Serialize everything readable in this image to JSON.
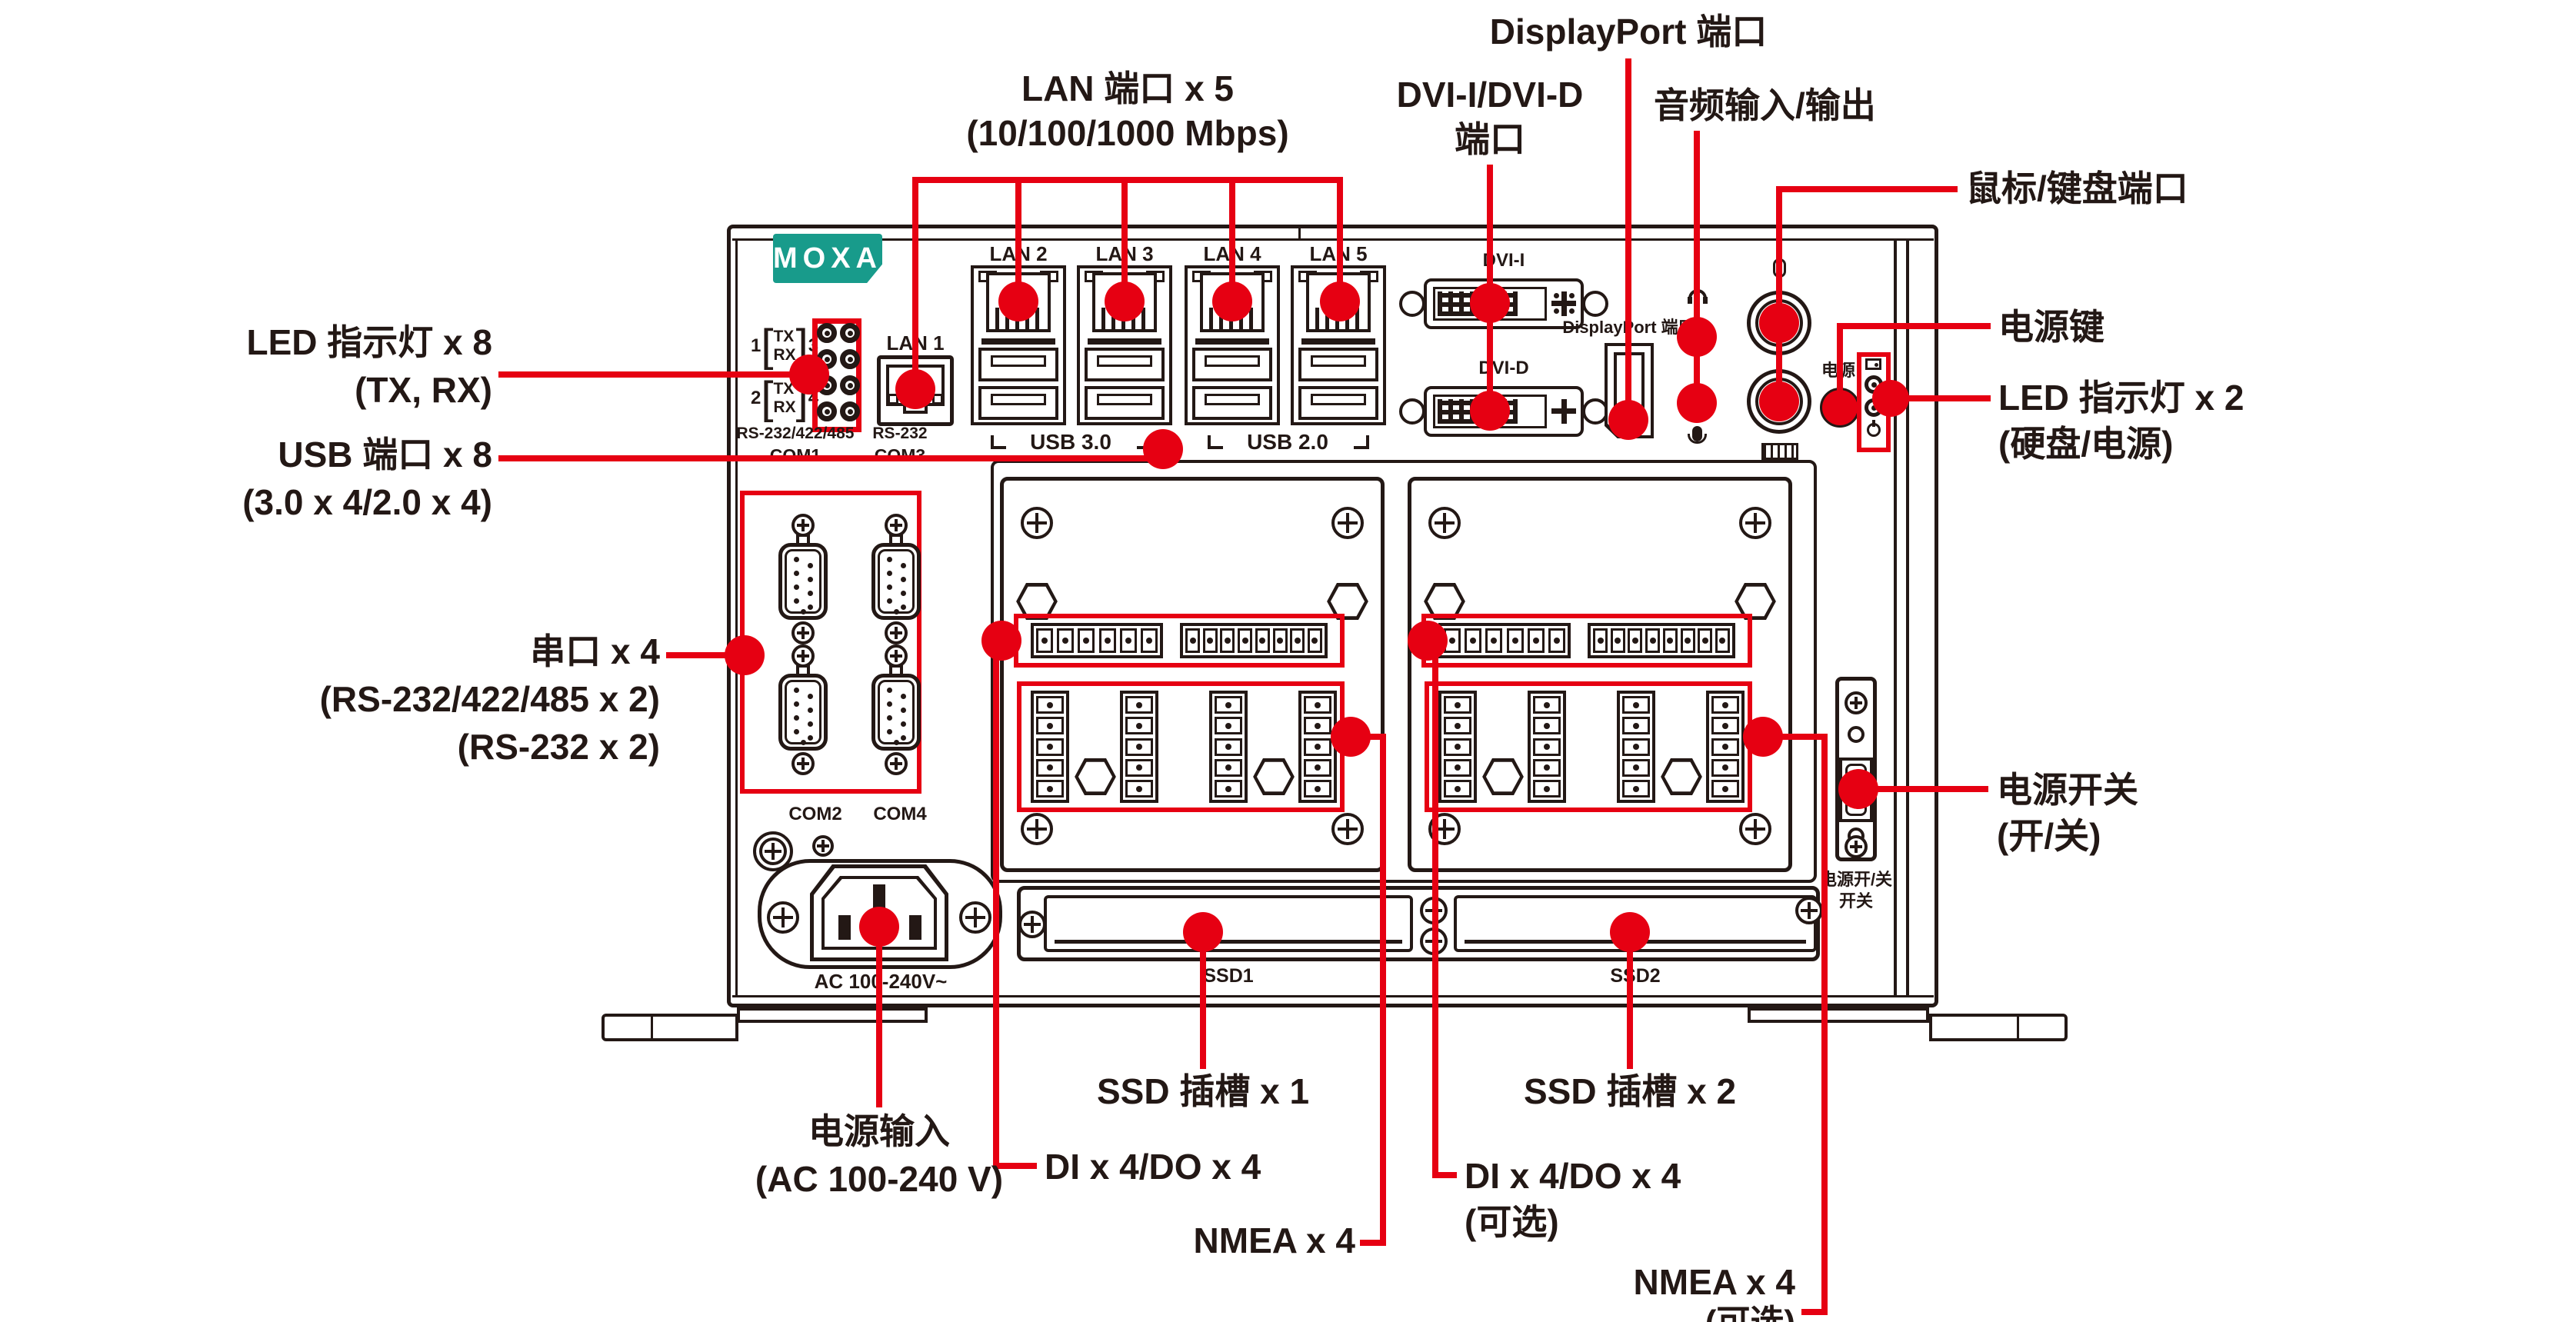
{
  "figure": {
    "brand": "MOXA",
    "colors": {
      "accent": "#E60012",
      "brand_teal": "#189B8B",
      "line_art": "#231815"
    },
    "callouts": {
      "lan": {
        "line1": "LAN 端口 x 5",
        "line2": "(10/100/1000 Mbps)"
      },
      "dvi": {
        "line1": "DVI-I/DVI-D",
        "line2": "端口"
      },
      "displayport": {
        "line1": "DisplayPort 端口"
      },
      "audio": {
        "line1": "音频输入/输出"
      },
      "mouse_keyboard": {
        "line1": "鼠标/键盘端口"
      },
      "led8": {
        "line1": "LED 指示灯 x 8",
        "line2": "(TX, RX)"
      },
      "usb8": {
        "line1": "USB 端口 x 8",
        "line2": "(3.0 x 4/2.0 x 4)"
      },
      "serial": {
        "line1": "串口 x 4",
        "line2": "(RS-232/422/485 x 2)",
        "line3": "(RS-232 x 2)"
      },
      "power_button": {
        "line1": "电源键"
      },
      "led2": {
        "line1": "LED 指示灯 x 2",
        "line2": "(硬盘/电源)"
      },
      "power_switch": {
        "line1": "电源开关",
        "line2": "(开/关)"
      },
      "power_input": {
        "line1": "电源输入",
        "line2": "(AC 100-240 V)"
      },
      "dido_left": {
        "line1": "DI x 4/DO x 4"
      },
      "nmea_left": {
        "line1": "NMEA x 4"
      },
      "ssd1": {
        "line1": "SSD 插槽 x 1"
      },
      "ssd2": {
        "line1": "SSD 插槽 x 2"
      },
      "dido_right": {
        "line1": "DI x 4/DO x 4",
        "line2": "(可选)"
      },
      "nmea_right": {
        "line1": "NMEA x 4",
        "line2": "(可选)"
      }
    },
    "panel": {
      "led_block": {
        "group1": {
          "left": "1",
          "top": "TX",
          "bottom": "RX",
          "right": "3"
        },
        "group2": {
          "left": "2",
          "top": "TX",
          "bottom": "RX",
          "right": "4"
        }
      },
      "com_top": [
        {
          "type": "RS-232/422/485",
          "port": "COM1"
        },
        {
          "type": "RS-232",
          "port": "COM3"
        }
      ],
      "com_bottom": [
        "COM2",
        "COM4"
      ],
      "lan1": "LAN 1",
      "lan2": "LAN 2",
      "lan3": "LAN 3",
      "lan4": "LAN 4",
      "lan5": "LAN 5",
      "usb30": "USB 3.0",
      "usb20": "USB 2.0",
      "dvi_i": "DVI-I",
      "dvi_d": "DVI-D",
      "displayport": "DisplayPort 端口",
      "power": "电源",
      "ac": "AC 100-240V~",
      "ssd1": "SSD1",
      "ssd2": "SSD2",
      "switch_line1": "电源开/关",
      "switch_line2": "开关"
    }
  }
}
